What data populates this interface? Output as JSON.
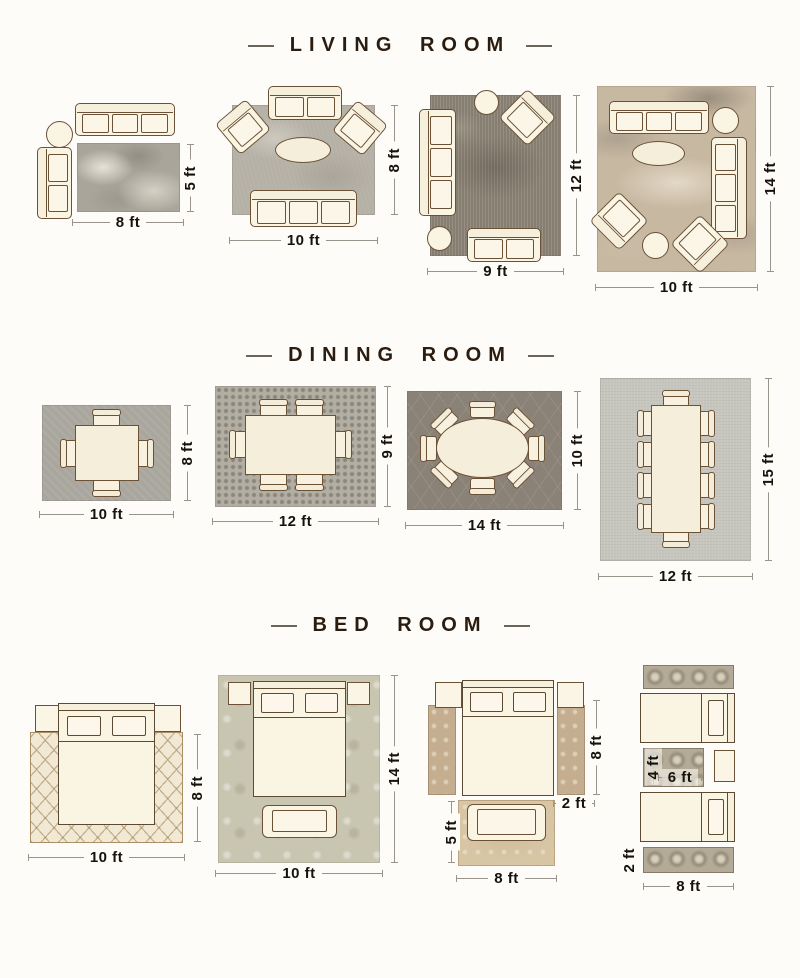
{
  "palette": {
    "background": "#fdfcf9",
    "title_text": "#2b1c10",
    "dimension_text": "#17120c",
    "dimension_line": "#98948b",
    "furniture_fill": "#faf4e3",
    "furniture_outline": "#6b5136"
  },
  "living_room": {
    "title": "LIVING ROOM",
    "layouts": [
      {
        "rug_width": "8 ft",
        "rug_height": "5 ft"
      },
      {
        "rug_width": "10 ft",
        "rug_height": "8 ft"
      },
      {
        "rug_width": "9 ft",
        "rug_height": "12 ft"
      },
      {
        "rug_width": "10 ft",
        "rug_height": "14 ft"
      }
    ]
  },
  "dining_room": {
    "title": "DINING ROOM",
    "layouts": [
      {
        "rug_width": "10 ft",
        "rug_height": "8 ft"
      },
      {
        "rug_width": "12 ft",
        "rug_height": "9 ft"
      },
      {
        "rug_width": "14 ft",
        "rug_height": "10 ft"
      },
      {
        "rug_width": "12 ft",
        "rug_height": "15 ft"
      }
    ]
  },
  "bed_room": {
    "title": "BED ROOM",
    "layouts": [
      {
        "rug_width": "10 ft",
        "rug_height": "8 ft"
      },
      {
        "rug_width": "10 ft",
        "rug_height": "14 ft"
      },
      {
        "side_runner_height": "8 ft",
        "side_runner_width": "2 ft",
        "foot_rug_height": "5 ft",
        "foot_rug_width": "8 ft"
      },
      {
        "center_rug_height": "4 ft",
        "center_rug_width": "6 ft",
        "runner_height": "2 ft",
        "runner_width": "8 ft"
      }
    ]
  }
}
